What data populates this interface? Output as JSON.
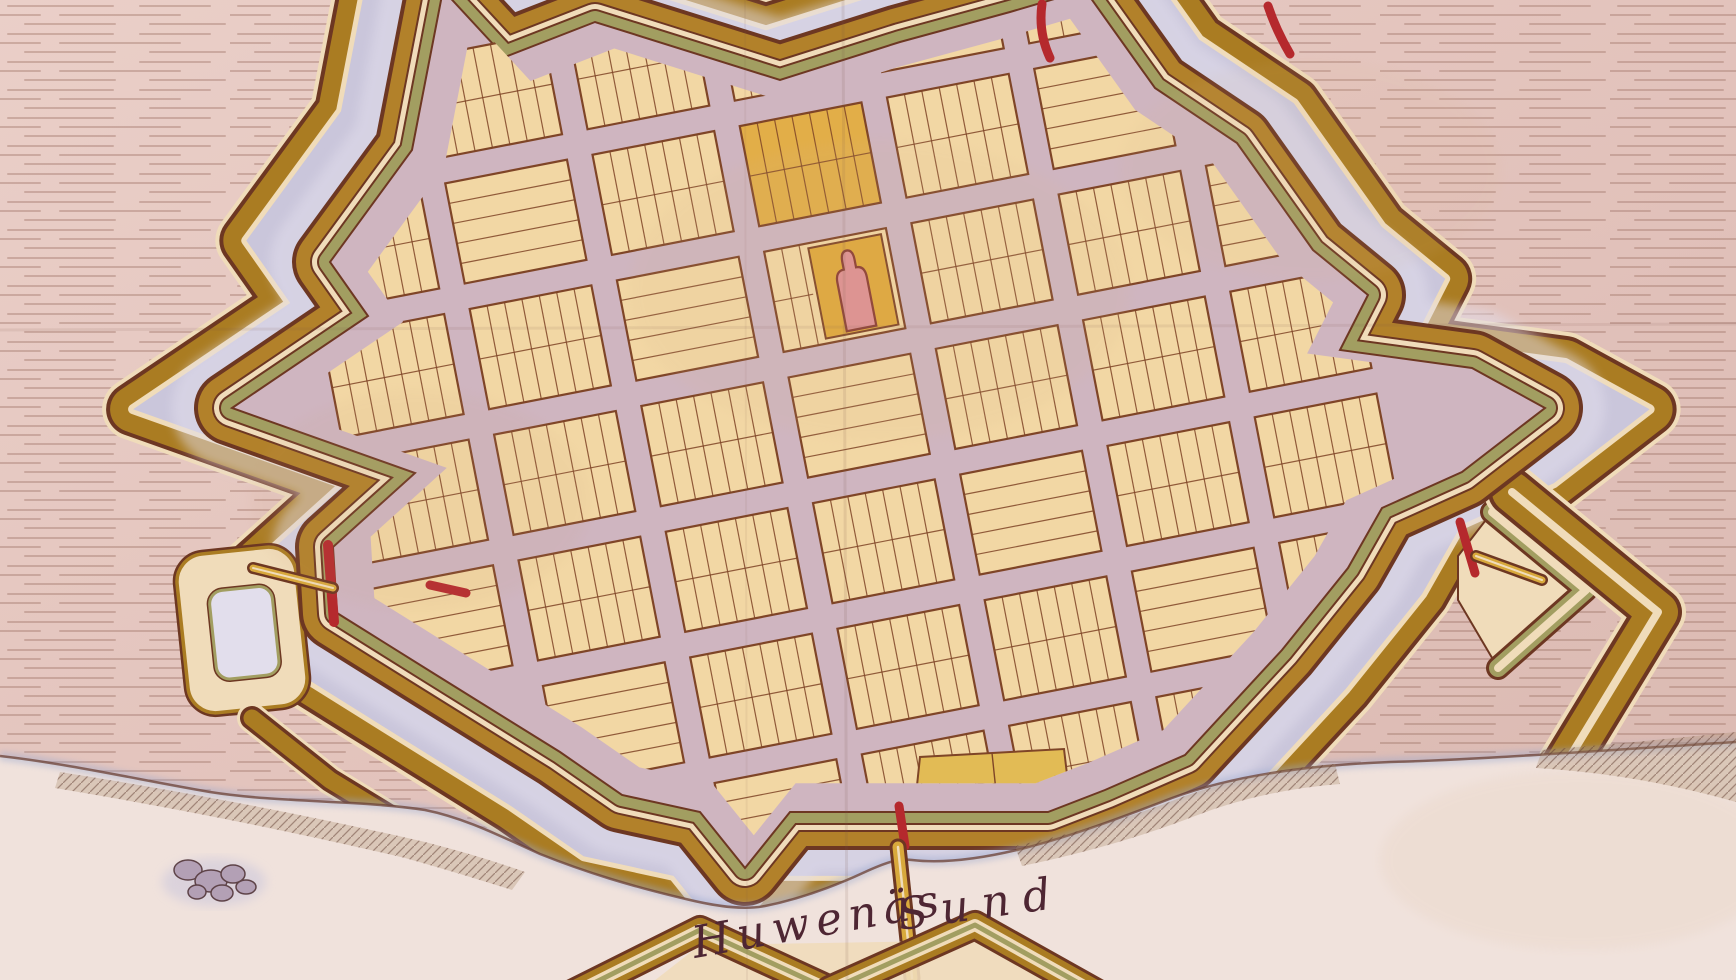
{
  "map": {
    "region_label": {
      "word1": "Huwenäs",
      "word2": "Sund",
      "full": "Huwenäs Sund"
    },
    "map_type": "hand-drawn fortified town plan with star-fort bastions, moat and gridded town",
    "features": [
      "terrain-hatching",
      "glacis-outer-rampart",
      "moat",
      "star-fort-enceinte",
      "esplanade",
      "city-grid-blocks",
      "church",
      "market-square",
      "north-gate",
      "west-gate",
      "south-gate",
      "east-gate",
      "west-hornwork",
      "east-ravelin",
      "southeast-glacis",
      "harbor-jetty",
      "south-sconce",
      "islet",
      "huwenas-sound"
    ],
    "colors": {
      "paper": "#e5c8c2",
      "paper_dark": "#dcbcb4",
      "hatch": "#a1766b",
      "moat": "#cac6db",
      "moat_light": "#e2deec",
      "wall_gold": "#b2812a",
      "glacis_gold": "#aa7c22",
      "wall_olive": "#a29e61",
      "wall_cream": "#f0dcba",
      "outline_dark": "#6d3722",
      "street": "#cfb5c0",
      "block_fill": "#f2d7a4",
      "block_line": "#7f4527",
      "block_yellow": "#e2ae48",
      "wedge_yellow": "#e2bb55",
      "square_orange": "#dfa83c",
      "church_pink": "#de9193",
      "church_line": "#8a3d33",
      "gate_red": "#b5292d",
      "bridge_gold": "#d8a93c",
      "water": "#f0e2dc",
      "water_edge": "#9aa8cf",
      "shore_line": "#6b4034",
      "ridge_base": "#a98868",
      "islet": "#b3a0b5",
      "islet_line": "#5e4348",
      "ink": "#4e2633",
      "crease": "#7a5548"
    },
    "grid": {
      "cols": 7,
      "rows": 7,
      "block_w": 124,
      "block_h": 102,
      "street_w": 26,
      "lots_per_row": 7,
      "origin": {
        "x": 298,
        "y": 212
      },
      "rotation_deg": -11,
      "church_block": [
        3,
        2
      ],
      "yellow_blocks": [
        [
          3,
          1
        ]
      ],
      "south_yellow_wedge": "916,795 920,757 1064,749 1068,783"
    }
  }
}
